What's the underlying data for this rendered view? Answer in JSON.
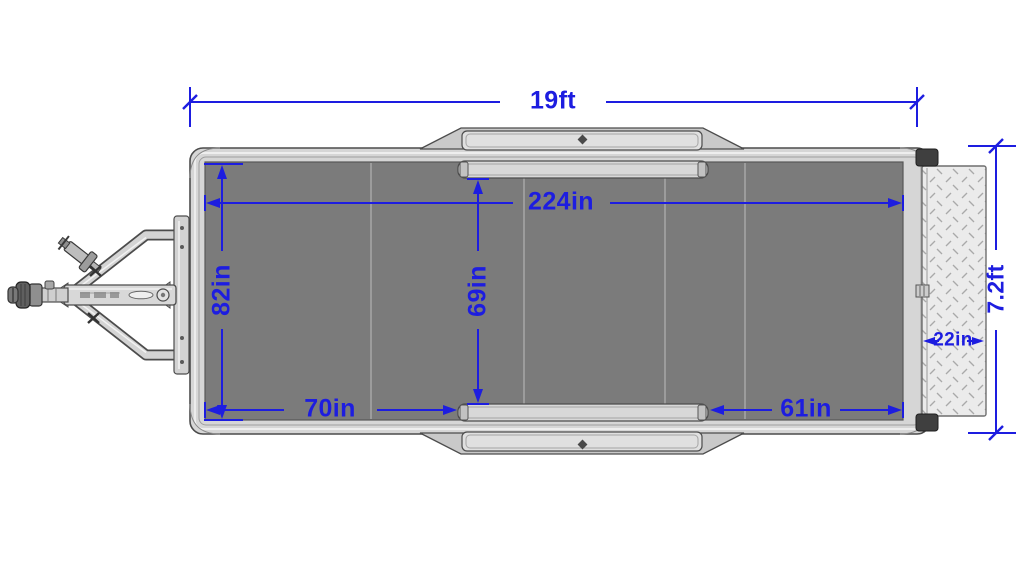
{
  "diagram": {
    "subject": "Utility trailer top view dimension drawing",
    "view": "top",
    "accent_color": "#1d1de0",
    "deck_color": "#7b7b7b",
    "frame_color": "#d6d6d6",
    "ramp_color": "#ebebeb",
    "dimensions": {
      "overall_length": "19ft",
      "deck_length": "224in",
      "deck_width": "82in",
      "width_between_fenders": "69in",
      "deck_ahead_of_fenders": "70in",
      "deck_behind_fenders": "61in",
      "ramp_depth": "22in",
      "ramp_span": "7.2ft"
    }
  }
}
